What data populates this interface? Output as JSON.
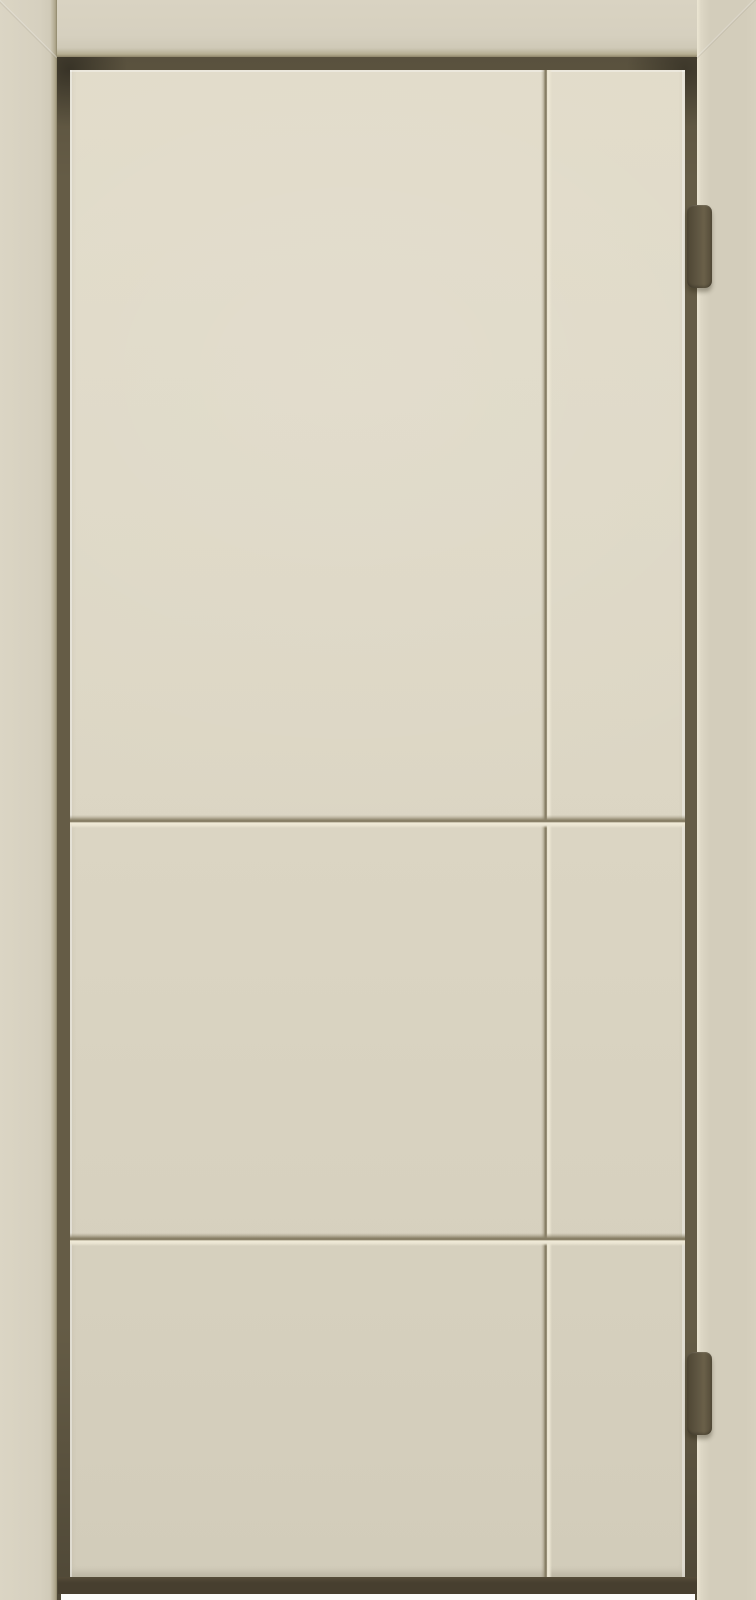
{
  "meta": {
    "subject": "Ivory painted interior door with frame, grooved panel grid and two concealed hinges on the right edge"
  },
  "door": {
    "hinges": {
      "count": 2,
      "positions": [
        "upper-right",
        "lower-right"
      ]
    },
    "grooves": {
      "vertical_count": 1,
      "horizontal_count": 2
    }
  },
  "colors": {
    "frame": "#d6d0bf",
    "frame-light": "#dbd5c4",
    "frame-right": "#d3cdbb",
    "frame-edge-dark": "#8f866a",
    "leaf-top": "#e1dbc9",
    "leaf-mid": "#dcd6c4",
    "leaf-bottom": "#d2ccba",
    "reveal": "#655c46",
    "reveal-dark": "#4a422f",
    "hinge": "#5e5541",
    "hinge-dark": "#4e4634",
    "hinge-light": "#6a6049",
    "groove-dark": "#8b8269",
    "groove-deep": "#7e755c",
    "groove-light": "#f0ead7",
    "bottom-shadow": "#473f2f",
    "floor": "#fcfcfa"
  }
}
